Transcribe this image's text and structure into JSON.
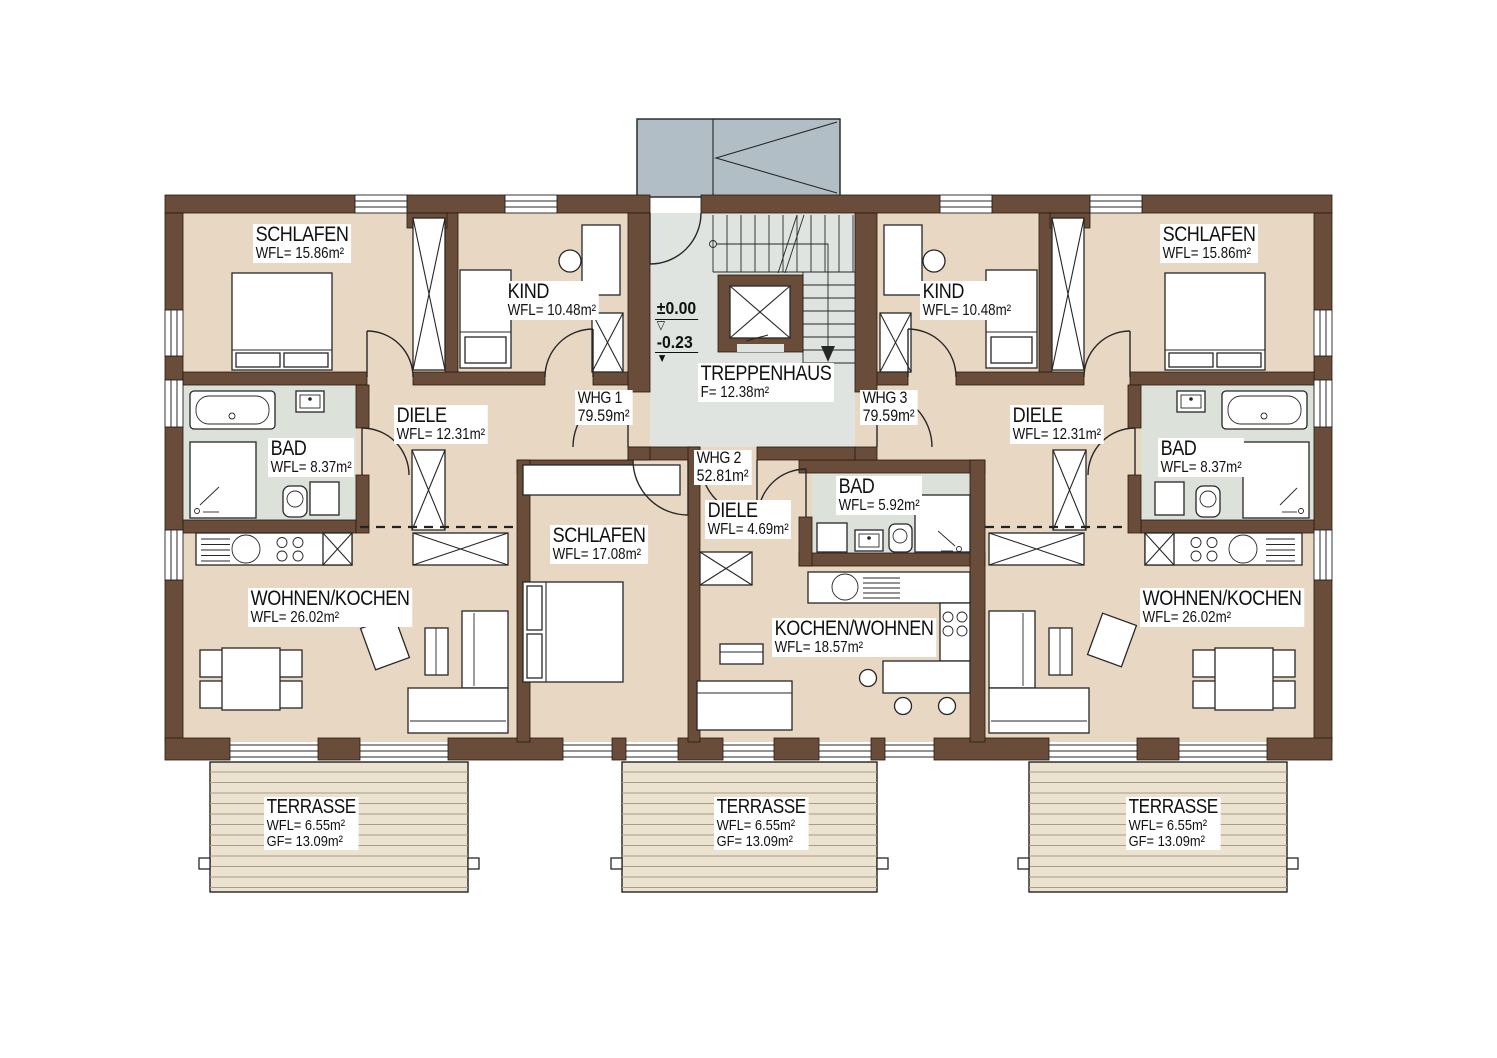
{
  "colors": {
    "wall": "#6a4c3a",
    "floor": "#e8d8c3",
    "bath": "#dce1da",
    "stair": "#dfe4e1",
    "canopy": "#b2bec6",
    "terrace": "#ece2d0",
    "terrace-line": "#a89c8a"
  },
  "labels": {
    "rooms": {
      "schlafen_l": {
        "name": "SCHLAFEN",
        "area": "WFL=  15.86m²"
      },
      "kind_l": {
        "name": "KIND",
        "area": "WFL=  10.48m²"
      },
      "bad_l": {
        "name": "BAD",
        "area": "WFL=  8.37m²"
      },
      "diele_l": {
        "name": "DIELE",
        "area": "WFL=  12.31m²"
      },
      "wohnen_l": {
        "name": "WOHNEN/KOCHEN",
        "area": "WFL=  26.02m²"
      },
      "schlafen_m": {
        "name": "SCHLAFEN",
        "area": "WFL=  17.08m²"
      },
      "diele_m": {
        "name": "DIELE",
        "area": "WFL=  4.69m²"
      },
      "bad_m": {
        "name": "BAD",
        "area": "WFL=  5.92m²"
      },
      "kochen_m": {
        "name": "KOCHEN/WOHNEN",
        "area": "WFL=  18.57m²"
      },
      "kind_r": {
        "name": "KIND",
        "area": "WFL=  10.48m²"
      },
      "schlafen_r": {
        "name": "SCHLAFEN",
        "area": "WFL=  15.86m²"
      },
      "bad_r": {
        "name": "BAD",
        "area": "WFL=  8.37m²"
      },
      "diele_r": {
        "name": "DIELE",
        "area": "WFL=  12.31m²"
      },
      "wohnen_r": {
        "name": "WOHNEN/KOCHEN",
        "area": "WFL=  26.02m²"
      },
      "treppenhaus": {
        "name": "TREPPENHAUS",
        "area": "F=  12.38m²"
      }
    },
    "apartments": {
      "whg1": {
        "name": "WHG 1",
        "area": "79.59m²"
      },
      "whg2": {
        "name": "WHG 2",
        "area": "52.81m²"
      },
      "whg3": {
        "name": "WHG 3",
        "area": "79.59m²"
      }
    },
    "levels": {
      "ground": "±0.00",
      "lower": "-0.23"
    },
    "terraces": {
      "t1": {
        "name": "TERRASSE",
        "wfl": "WFL=  6.55m²",
        "gf": "GF=  13.09m²"
      },
      "t2": {
        "name": "TERRASSE",
        "wfl": "WFL=  6.55m²",
        "gf": "GF=  13.09m²"
      },
      "t3": {
        "name": "TERRASSE",
        "wfl": "WFL=  6.55m²",
        "gf": "GF=  13.09m²"
      }
    }
  }
}
